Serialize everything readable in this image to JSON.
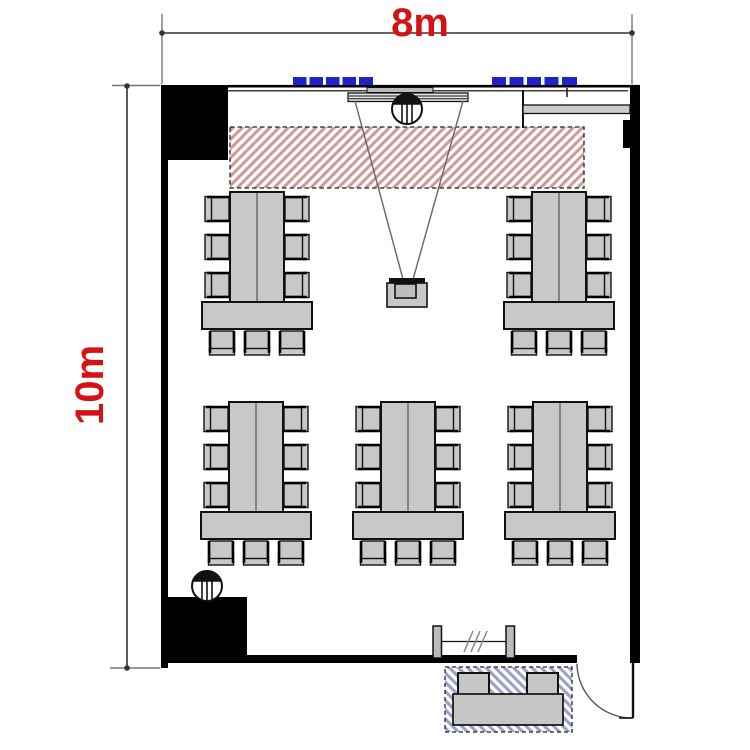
{
  "page": {
    "title": "Room floor plan"
  },
  "dimension_labels": {
    "width": "8m",
    "height": "10m"
  },
  "colors": {
    "dimension_text": "#d41414",
    "wall": "#000000",
    "furniture_fill": "#c8c8c8",
    "light_strip_blue": "#2222cc",
    "projection_zone_hatch": "#cf9a9a",
    "entrance_zone_hatch": "#9aa0c8"
  },
  "objects": {
    "projection_screen": "wall-mounted-screen",
    "front_fixture": "ceiling-fixture",
    "projection_zone": "hatched-no-furniture-zone",
    "projector": "ceiling-projector",
    "table_cluster_count": 5,
    "chairs_per_cluster": 9,
    "light_strip_groups": 2,
    "dashes_per_strip": 5,
    "door": "entrance-door-with-swing",
    "coat_rack": "coat-rack",
    "outside_bench": "bench-with-two-stools",
    "wall_counter": "shelf-counter"
  }
}
